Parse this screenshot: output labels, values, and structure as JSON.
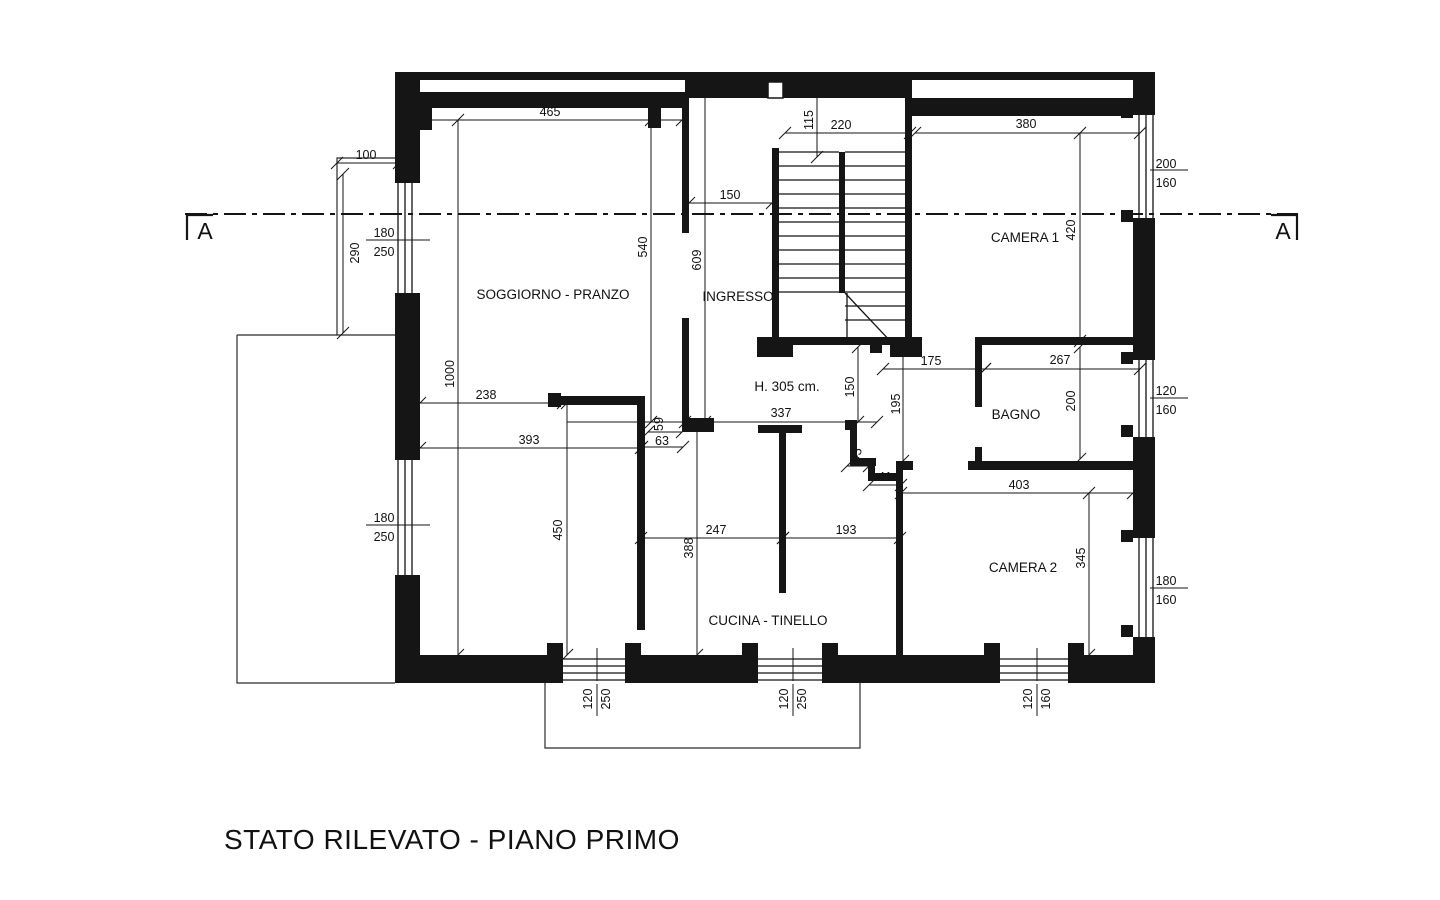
{
  "title": "STATO RILEVATO - PIANO PRIMO",
  "plan": {
    "section": {
      "label": "A"
    },
    "labels": [
      {
        "name": "room-label-soggiorno-pranzo",
        "label": "SOGGIORNO - PRANZO",
        "x": 553,
        "y": 299
      },
      {
        "name": "room-label-ingresso",
        "label": "INGRESSO",
        "x": 738,
        "y": 301
      },
      {
        "name": "room-label-camera-1",
        "label": "CAMERA 1",
        "x": 1025,
        "y": 242
      },
      {
        "name": "room-label-bagno",
        "label": "BAGNO",
        "x": 1016,
        "y": 419
      },
      {
        "name": "room-label-camera-2",
        "label": "CAMERA 2",
        "x": 1023,
        "y": 572
      },
      {
        "name": "room-label-cucina-tinello",
        "label": "CUCINA - TINELLO",
        "x": 768,
        "y": 625
      },
      {
        "name": "height-annotation",
        "label": "H. 305 cm.",
        "x": 787,
        "y": 391
      }
    ],
    "dims": [
      {
        "label": "465",
        "x1": 418,
        "y1": 120,
        "x2": 682,
        "y2": 120,
        "tx": 550,
        "ty": 116
      },
      {
        "label": "100",
        "x1": 337,
        "y1": 163,
        "x2": 399,
        "y2": 163,
        "tx": 366,
        "ty": 159
      },
      {
        "label": "290",
        "x1": 343,
        "y1": 174,
        "x2": 343,
        "y2": 333,
        "tx": 359,
        "ty": 253,
        "rot": -90
      },
      {
        "label": "1000",
        "x1": 458,
        "y1": 120,
        "x2": 458,
        "y2": 655,
        "tx": 454,
        "ty": 374,
        "rot": -90
      },
      {
        "label": "540",
        "x1": 651,
        "y1": 120,
        "x2": 651,
        "y2": 422,
        "tx": 647,
        "ty": 247,
        "rot": -90
      },
      {
        "label": "609",
        "x1": 705,
        "y1": 87,
        "x2": 705,
        "y2": 422,
        "tx": 701,
        "ty": 260,
        "rot": -90
      },
      {
        "label": "150",
        "x1": 689,
        "y1": 203,
        "x2": 772,
        "y2": 203,
        "tx": 730,
        "ty": 199
      },
      {
        "label": "115",
        "x1": 817,
        "y1": 86,
        "x2": 817,
        "y2": 157,
        "tx": 813,
        "ty": 120,
        "rot": -90
      },
      {
        "label": "220",
        "x1": 785,
        "y1": 133,
        "x2": 910,
        "y2": 133,
        "tx": 841,
        "ty": 129
      },
      {
        "label": "380",
        "x1": 915,
        "y1": 133,
        "x2": 1140,
        "y2": 133,
        "tx": 1026,
        "ty": 128
      },
      {
        "label": "420",
        "x1": 1080,
        "y1": 133,
        "x2": 1080,
        "y2": 341,
        "tx": 1075,
        "ty": 230,
        "rot": -90
      },
      {
        "label": "238",
        "x1": 420,
        "y1": 403,
        "x2": 563,
        "y2": 403,
        "tx": 486,
        "ty": 399
      },
      {
        "label": "393",
        "x1": 420,
        "y1": 448,
        "x2": 641,
        "y2": 448,
        "tx": 529,
        "ty": 444
      },
      {
        "label": "337",
        "x1": 685,
        "y1": 422,
        "x2": 877,
        "y2": 422,
        "tx": 781,
        "ty": 417
      },
      {
        "label": "59",
        "x1": 648,
        "y1": 432,
        "x2": 682,
        "y2": 432,
        "tx": 663,
        "ty": 424,
        "rot": -90
      },
      {
        "label": "63",
        "x1": 642,
        "y1": 447,
        "x2": 683,
        "y2": 447,
        "tx": 662,
        "ty": 445
      },
      {
        "label": "150",
        "x1": 858,
        "y1": 347,
        "x2": 858,
        "y2": 422,
        "tx": 854,
        "ty": 387,
        "rot": -90
      },
      {
        "label": "195",
        "x1": 903,
        "y1": 347,
        "x2": 903,
        "y2": 461,
        "tx": 900,
        "ty": 404,
        "rot": -90
      },
      {
        "label": "175",
        "x1": 883,
        "y1": 369,
        "x2": 985,
        "y2": 369,
        "tx": 931,
        "ty": 365
      },
      {
        "label": "267",
        "x1": 985,
        "y1": 369,
        "x2": 1140,
        "y2": 369,
        "tx": 1060,
        "ty": 364
      },
      {
        "label": "200",
        "x1": 1080,
        "y1": 347,
        "x2": 1080,
        "y2": 459,
        "tx": 1075,
        "ty": 401,
        "rot": -90
      },
      {
        "label": "45",
        "x1": 847,
        "y1": 466,
        "x2": 869,
        "y2": 466,
        "tx": 860,
        "ty": 456,
        "rot": -70
      },
      {
        "label": "41",
        "x1": 869,
        "y1": 485,
        "x2": 901,
        "y2": 485,
        "tx": 885,
        "ty": 481
      },
      {
        "label": "403",
        "x1": 901,
        "y1": 493,
        "x2": 1133,
        "y2": 493,
        "tx": 1019,
        "ty": 489
      },
      {
        "label": "345",
        "x1": 1089,
        "y1": 493,
        "x2": 1089,
        "y2": 655,
        "tx": 1085,
        "ty": 558,
        "rot": -90
      },
      {
        "label": "247",
        "x1": 641,
        "y1": 538,
        "x2": 783,
        "y2": 538,
        "tx": 716,
        "ty": 534
      },
      {
        "label": "193",
        "x1": 783,
        "y1": 538,
        "x2": 900,
        "y2": 538,
        "tx": 846,
        "ty": 534
      },
      {
        "label": "388",
        "x1": 697,
        "y1": 425,
        "x2": 697,
        "y2": 655,
        "tx": 693,
        "ty": 548,
        "rot": -90
      },
      {
        "label": "450",
        "x1": 567,
        "y1": 403,
        "x2": 567,
        "y2": 655,
        "tx": 562,
        "ty": 530,
        "rot": -90
      }
    ],
    "window_dims": [
      {
        "top": "180",
        "bottom": "250",
        "ttx": 384,
        "tty": 237,
        "btx": 384,
        "bty": 256,
        "lx1": 366,
        "ly1": 240,
        "lx2": 430,
        "ly2": 240
      },
      {
        "top": "180",
        "bottom": "250",
        "ttx": 384,
        "tty": 522,
        "btx": 384,
        "bty": 541,
        "lx1": 366,
        "ly1": 525,
        "lx2": 430,
        "ly2": 525
      },
      {
        "top": "200",
        "bottom": "160",
        "ttx": 1166,
        "tty": 168,
        "btx": 1166,
        "bty": 187,
        "lx1": 1150,
        "ly1": 170,
        "lx2": 1188,
        "ly2": 170
      },
      {
        "top": "120",
        "bottom": "160",
        "ttx": 1166,
        "tty": 395,
        "btx": 1166,
        "bty": 414,
        "lx1": 1150,
        "ly1": 398,
        "lx2": 1188,
        "ly2": 398
      },
      {
        "top": "180",
        "bottom": "160",
        "ttx": 1166,
        "tty": 585,
        "btx": 1166,
        "bty": 604,
        "lx1": 1150,
        "ly1": 588,
        "lx2": 1188,
        "ly2": 588
      },
      {
        "top": "120",
        "bottom": "250",
        "rot": true,
        "ttx": 592,
        "tty": 699,
        "btx": 610,
        "bty": 699,
        "lx1": 597,
        "ly1": 684,
        "lx2": 597,
        "ly2": 716,
        "ex1": 597,
        "ey1": 648,
        "ex2": 597,
        "ey2": 681
      },
      {
        "top": "120",
        "bottom": "250",
        "rot": true,
        "ttx": 788,
        "tty": 699,
        "btx": 806,
        "bty": 699,
        "lx1": 793,
        "ly1": 684,
        "lx2": 793,
        "ly2": 716,
        "ex1": 793,
        "ey1": 648,
        "ex2": 793,
        "ey2": 681
      },
      {
        "top": "120",
        "bottom": "160",
        "rot": true,
        "ttx": 1032,
        "tty": 699,
        "btx": 1050,
        "bty": 699,
        "lx1": 1037,
        "ly1": 684,
        "lx2": 1037,
        "ly2": 716,
        "ex1": 1037,
        "ey1": 648,
        "ex2": 1037,
        "ey2": 681
      }
    ]
  }
}
